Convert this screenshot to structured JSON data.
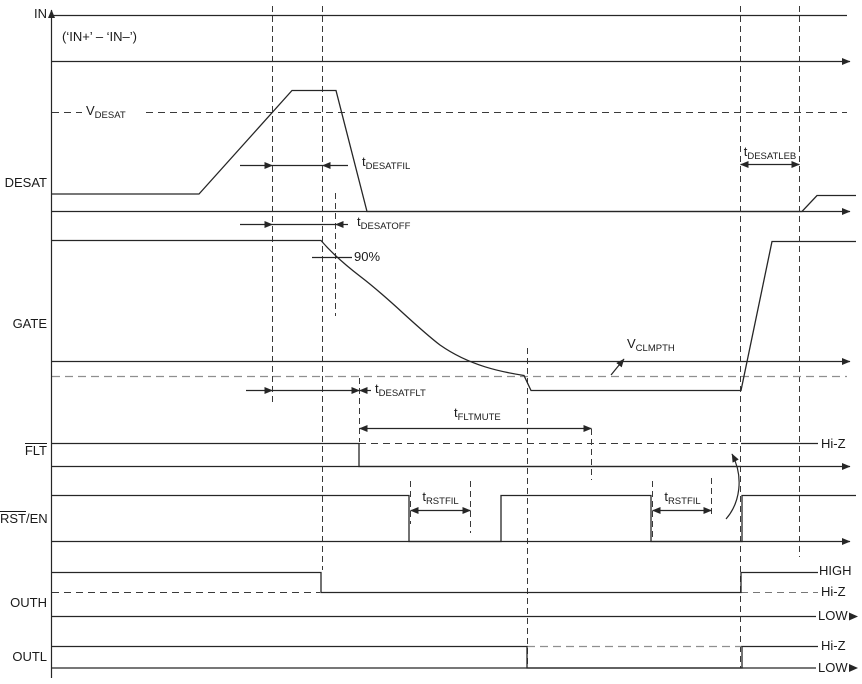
{
  "figure": {
    "background": "#ffffff",
    "line_color": "#262626",
    "gray_dash_color": "#8f8f8f"
  },
  "rows": [
    {
      "id": "in",
      "label": "IN"
    },
    {
      "id": "desat",
      "label": "DESAT"
    },
    {
      "id": "gate",
      "label": "GATE"
    },
    {
      "id": "flt",
      "label": "FLT",
      "overline": true
    },
    {
      "id": "rst_en",
      "label_overline": "RST",
      "label_rest": "/EN"
    },
    {
      "id": "outh",
      "label": "OUTH"
    },
    {
      "id": "outl",
      "label": "OUTL"
    }
  ],
  "annotations": {
    "in_note": "(‘IN+’ – ‘IN–’)",
    "v_desat": {
      "base": "V",
      "sub": "DESAT"
    },
    "v_clmpth": {
      "base": "V",
      "sub": "CLMPTH"
    },
    "t_desatfil": {
      "base": "t",
      "sub": "DESATFIL"
    },
    "t_desatoff": {
      "base": "t",
      "sub": "DESATOFF"
    },
    "t_desatflt": {
      "base": "t",
      "sub": "DESATFLT"
    },
    "t_desatleb": {
      "base": "t",
      "sub": "DESATLEB"
    },
    "t_fltmute": {
      "base": "t",
      "sub": "FLTMUTE"
    },
    "t_rstfil_1": {
      "base": "t",
      "sub": "RSTFIL"
    },
    "t_rstfil_2": {
      "base": "t",
      "sub": "RSTFIL"
    },
    "gate_90": "90%"
  },
  "right_labels": {
    "flt_hiz": "Hi-Z",
    "outh_high": "HIGH",
    "outh_hiz": "Hi-Z",
    "outh_low": "LOW",
    "outl_hiz": "Hi-Z",
    "outl_low": "LOW"
  }
}
